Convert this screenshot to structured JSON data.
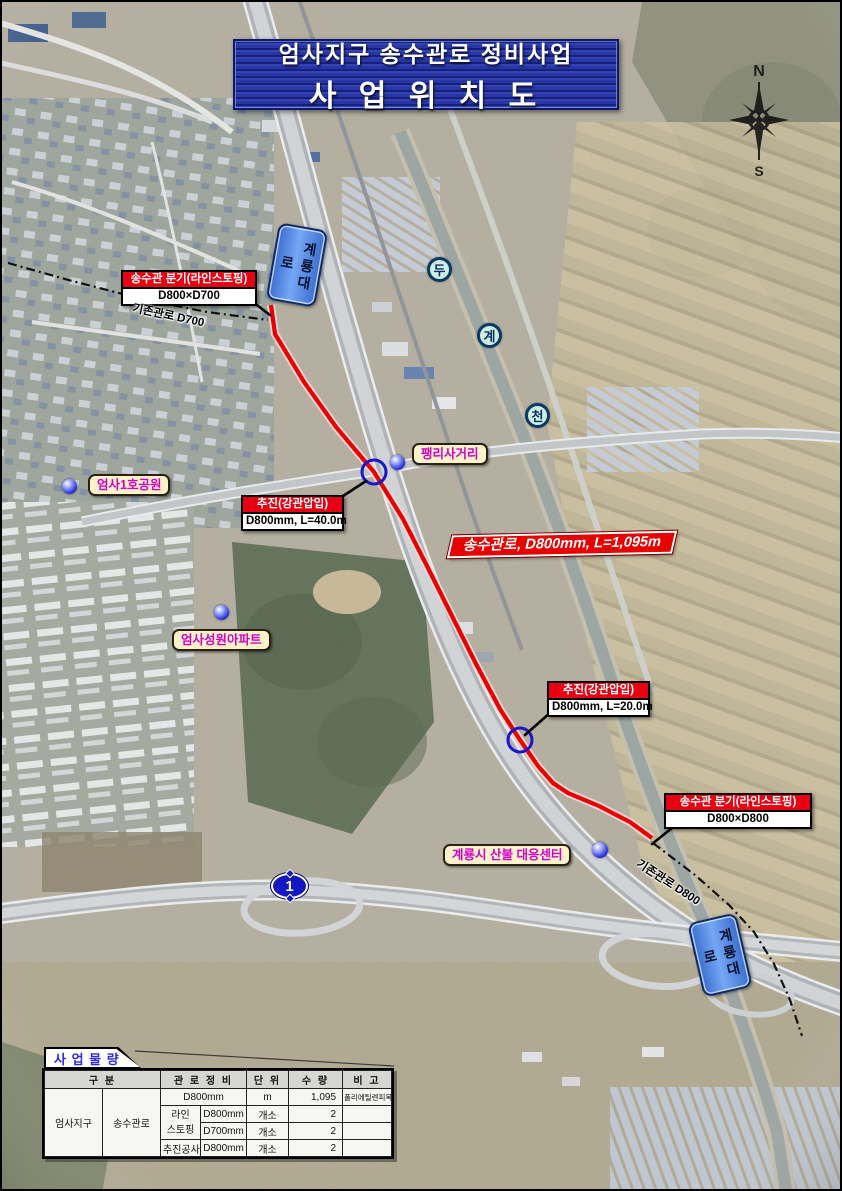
{
  "page": {
    "title_line1": "엄사지구 송수관로 정비사업",
    "title_line2": "사 업 위 치 도"
  },
  "compass": {
    "north": "N",
    "south": "S"
  },
  "roads": {
    "gyeryongdaero_top": "계룡대로",
    "gyeryongdaero_bottom": "계룡대로",
    "route1": "1"
  },
  "stream": {
    "char1": "두",
    "char2": "계",
    "char3": "천"
  },
  "pipes": {
    "existing_d700": "기존관로 D700",
    "existing_d800": "기존관로 D800",
    "banner": "송수관로, D800mm, L=1,095m"
  },
  "callouts": {
    "branch_top": {
      "header": "송수관 분기(라인스토핑)",
      "body": "D800×D700"
    },
    "jacking_40": {
      "header": "추진(강관압입)",
      "body": "D800mm, L=40.0m"
    },
    "jacking_20": {
      "header": "추진(강관압입)",
      "body": "D800mm, L=20.0m"
    },
    "branch_bottom": {
      "header": "송수관 분기(라인스토핑)",
      "body": "D800×D800"
    }
  },
  "places": {
    "pyeongni": "팽리사거리",
    "park": "엄사1호공원",
    "apartment": "엄사성원아파트",
    "fire_center": "계룡시 산불 대응센터"
  },
  "table": {
    "tab_title": "사 업 물 량",
    "headers": {
      "category": "구 분",
      "pipe_work": "관 로 정 비",
      "unit": "단 위",
      "qty": "수 량",
      "remark": "비 고"
    },
    "category": {
      "district": "엄사지구",
      "facility": "송수관로"
    },
    "rows": {
      "r1": {
        "spec": "D800mm",
        "unit": "m",
        "qty": "1,095",
        "remark": "폴리에틸렌피복강관"
      },
      "linestop": {
        "line1": "라인",
        "line2": "스토핑"
      },
      "r2": {
        "spec": "D800mm",
        "unit": "개소",
        "qty": "2",
        "remark": ""
      },
      "r3": {
        "spec": "D700mm",
        "unit": "개소",
        "qty": "2",
        "remark": ""
      },
      "r4": {
        "work": "추진공사",
        "spec": "D800mm",
        "unit": "개소",
        "qty": "2",
        "remark": ""
      }
    }
  },
  "colors": {
    "route_red": "#e60000",
    "callout_red": "#e60012",
    "label_magenta": "#d400cc",
    "title_blue": "#2836a6",
    "marker_blue": "#1a16cc"
  }
}
